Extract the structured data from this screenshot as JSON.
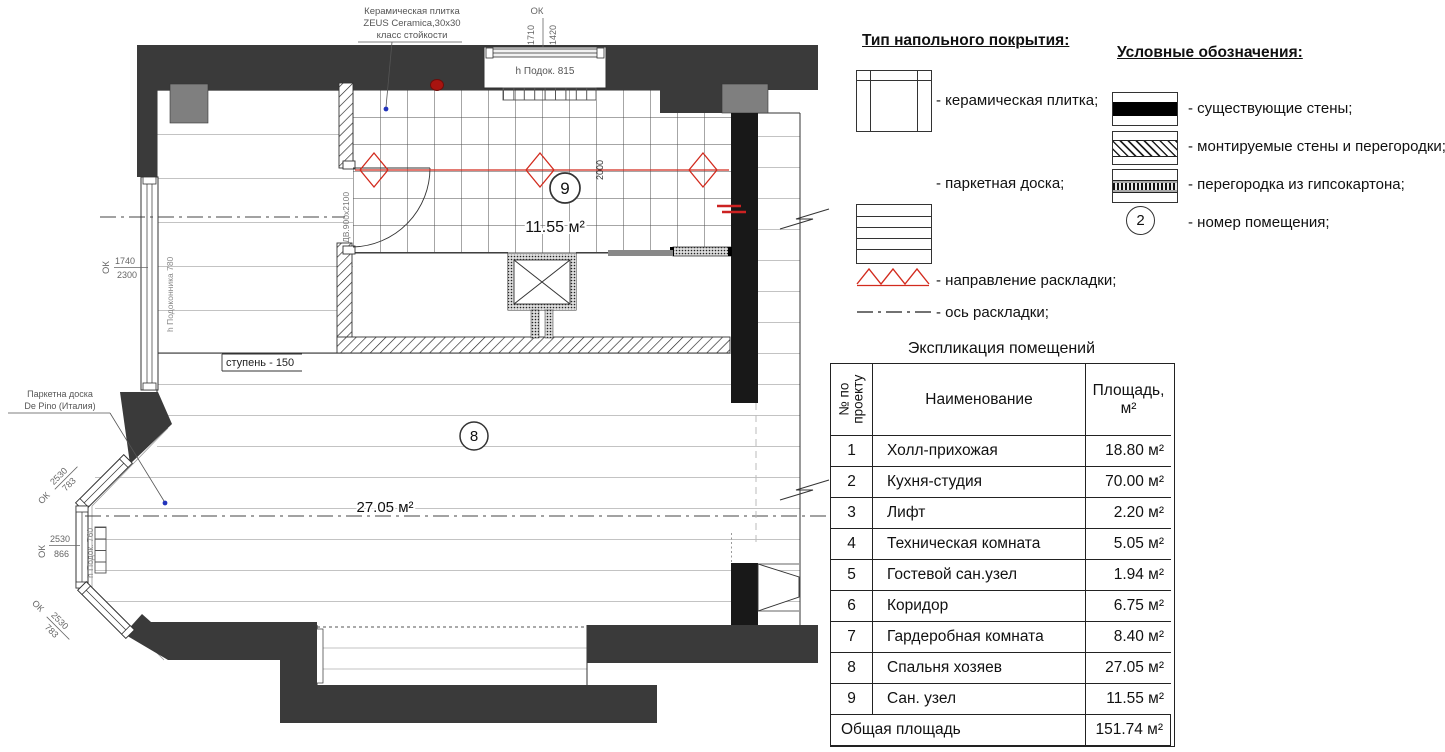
{
  "colors": {
    "wall_existing": "#3a3a3a",
    "wall_black": "#181818",
    "pilaster_gray": "#7f7f7f",
    "accent_red": "#d22b1e",
    "leader_blue": "#2233bb",
    "dim_gray": "#6e6e6e",
    "floor_line": "#c3c3c3"
  },
  "plan": {
    "notes": {
      "tile_note_line1": "Керамическая плитка",
      "tile_note_line2": "ZEUS Ceramica,30x30",
      "tile_note_line3": "класс стойкости",
      "parquet_note_line1": "Паркетна доска",
      "parquet_note_line2": "De Pino (Италия)",
      "step_label": "ступень - 150"
    },
    "dimensions": {
      "top_window_mark": "ОК",
      "top_window_width": "1710",
      "top_window_height": "1420",
      "top_window_sill": "h Подок. 815",
      "left_window_mark": "ОК",
      "left_window_width": "1740",
      "left_window_height": "2300",
      "left_window_sill": "h Подоконника 780",
      "bay_top_mark": "ОК",
      "bay_top_width": "2530",
      "bay_top_height": "783",
      "bay_mid_mark": "ОК",
      "bay_mid_width": "2530",
      "bay_mid_height": "866",
      "bay_bottom_mark": "ОК",
      "bay_bottom_width": "2530",
      "bay_bottom_height": "783",
      "bay_sill": "h Подок. 760",
      "door_label": "ДВ.900х2100",
      "tile_run": "2000"
    },
    "rooms": {
      "room8": {
        "number": "8",
        "area": "27.05 м²"
      },
      "room9": {
        "number": "9",
        "area": "11.55 м²"
      }
    }
  },
  "legend_flooring": {
    "title": "Тип напольного покрытия:",
    "ceramic_label": "- керамическая плитка;",
    "parquet_label": "- паркетная доска;"
  },
  "legend_symbols": {
    "title": "Условные обозначения:",
    "existing_walls": "- существующие стены;",
    "mounted_walls": "- монтируемые стены и перегородки;",
    "gypsum_partition": "- перегородка из гипсокартона;",
    "room_number": "- номер помещения;",
    "room_number_example": "2",
    "layout_direction": "- направление раскладки;",
    "layout_axis": "- ось раскладки;"
  },
  "schedule": {
    "title": "Экспликация помещений",
    "headers": {
      "col1_line1": "№ по",
      "col1_line2": "проекту",
      "col2": "Наименование",
      "col3_line1": "Площадь,",
      "col3_line2": "м²"
    },
    "rows": [
      {
        "num": "1",
        "name": "Холл-прихожая",
        "area": "18.80 м²"
      },
      {
        "num": "2",
        "name": "Кухня-студия",
        "area": "70.00 м²"
      },
      {
        "num": "3",
        "name": "Лифт",
        "area": "2.20 м²"
      },
      {
        "num": "4",
        "name": "Техническая комната",
        "area": "5.05 м²"
      },
      {
        "num": "5",
        "name": "Гостевой сан.узел",
        "area": "1.94 м²"
      },
      {
        "num": "6",
        "name": "Коридор",
        "area": "6.75 м²"
      },
      {
        "num": "7",
        "name": "Гардеробная комната",
        "area": "8.40 м²"
      },
      {
        "num": "8",
        "name": "Спальня хозяев",
        "area": "27.05 м²"
      },
      {
        "num": "9",
        "name": "Сан. узел",
        "area": "11.55 м²"
      }
    ],
    "total": {
      "label": "Общая площадь",
      "area": "151.74 м²"
    }
  }
}
